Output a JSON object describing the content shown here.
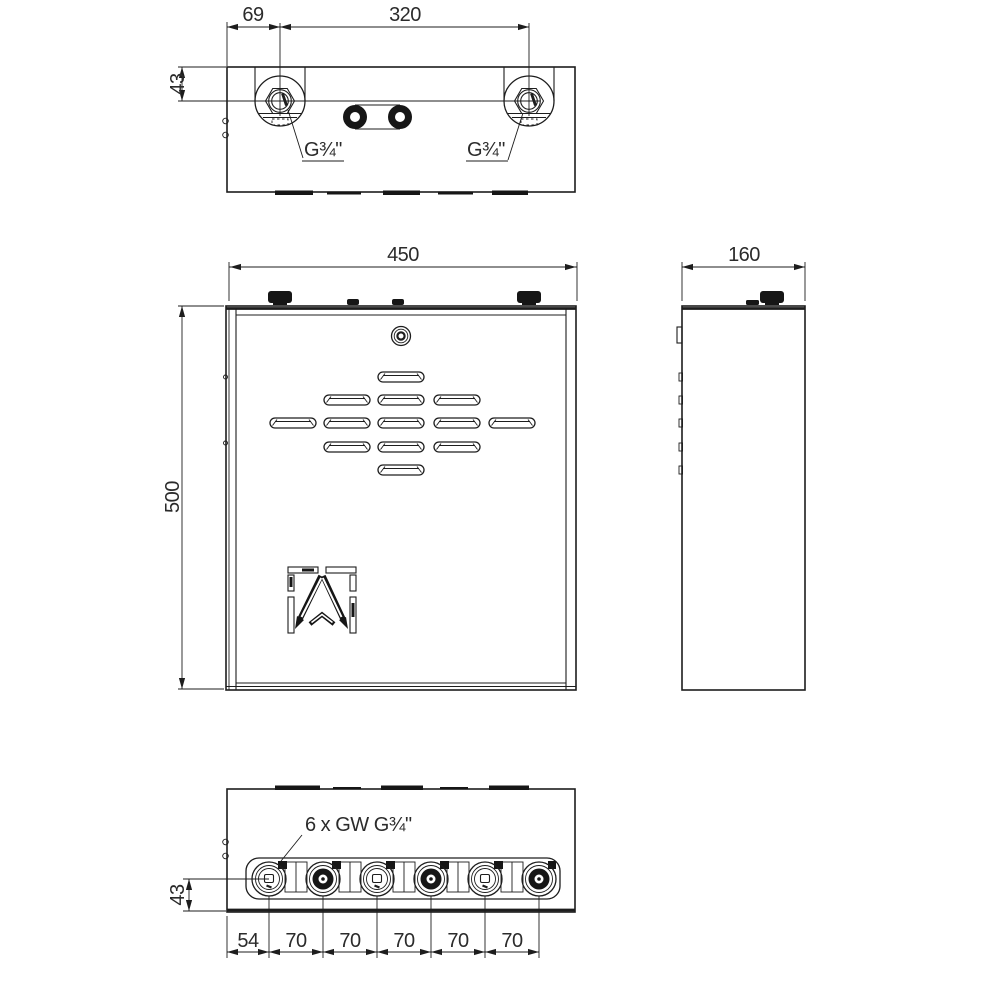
{
  "drawing": {
    "colors": {
      "background": "#ffffff",
      "line": "#1d1d1d",
      "text": "#2b2b2b"
    }
  },
  "dimensions": {
    "top_view": {
      "offset": "69",
      "spacing": "320",
      "height": "43"
    },
    "front_view": {
      "width": "450",
      "height": "500"
    },
    "side_view": {
      "depth": "160"
    },
    "bottom_view": {
      "height": "43",
      "spacings": [
        "54",
        "70",
        "70",
        "70",
        "70",
        "70"
      ]
    }
  },
  "callouts": {
    "thread_left": "G¾\"",
    "thread_right": "G¾\"",
    "bottom_threads": "6 x GW G¾\""
  }
}
